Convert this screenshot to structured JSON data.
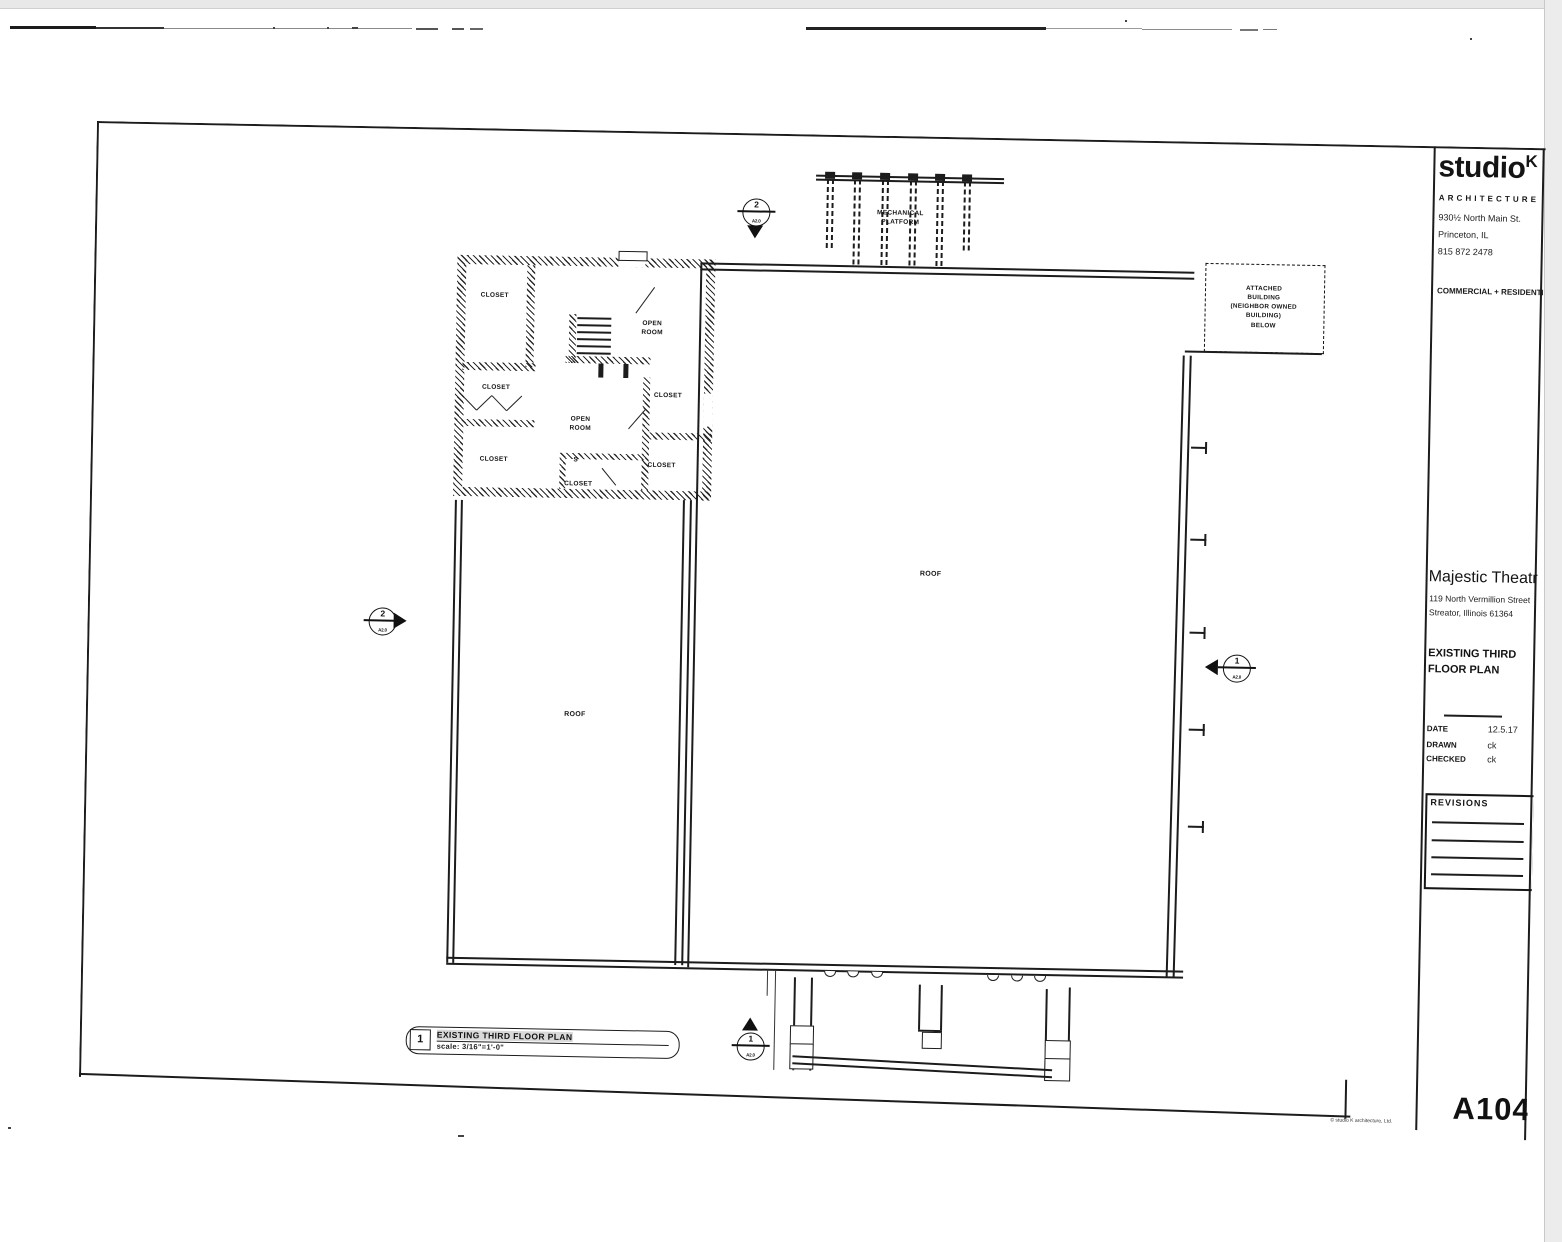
{
  "colors": {
    "ink": "#1c1c1c",
    "paper": "#ffffff"
  },
  "firm": {
    "name": "studio",
    "sup": "K",
    "type": "ARCHITECTURE",
    "address1": "930½ North Main St.",
    "address2": "Princeton, IL",
    "phone": "815 872 2478",
    "tagline": "COMMERCIAL + RESIDENTIAL"
  },
  "project": {
    "name": "Majestic Theatre",
    "address1": "119 North Vermillion Street",
    "address2": "Streator, Illinois  61364"
  },
  "titleblock": {
    "sheet_title": "EXISTING THIRD\nFLOOR PLAN",
    "date_label": "DATE",
    "date": "12.5.17",
    "drawn_label": "DRAWN",
    "drawn": "ck",
    "checked_label": "CHECKED",
    "checked": "ck",
    "revisions_label": "REVISIONS",
    "sheet_number": "A104",
    "copyright": "© studio K architecture, Ltd."
  },
  "drawing": {
    "number": "1",
    "title": "EXISTING THIRD FLOOR PLAN",
    "scale": "scale: 3/16\"=1'-0\""
  },
  "labels": {
    "mechanical": "MECHANICAL\nPLATFORM",
    "attached": "ATTACHED\nBUILDING\n(NEIGHBOR OWNED\nBUILDING)\nBELOW",
    "roof": "ROOF",
    "closet": "CLOSET",
    "open_room": "OPEN\nROOM",
    "s": "S"
  },
  "markers": {
    "top": {
      "num": "2",
      "sub": "A2.0"
    },
    "left": {
      "num": "2",
      "sub": "A2.0"
    },
    "right": {
      "num": "1",
      "sub": "A2.0"
    },
    "bottom": {
      "num": "1",
      "sub": "A2.0"
    }
  }
}
